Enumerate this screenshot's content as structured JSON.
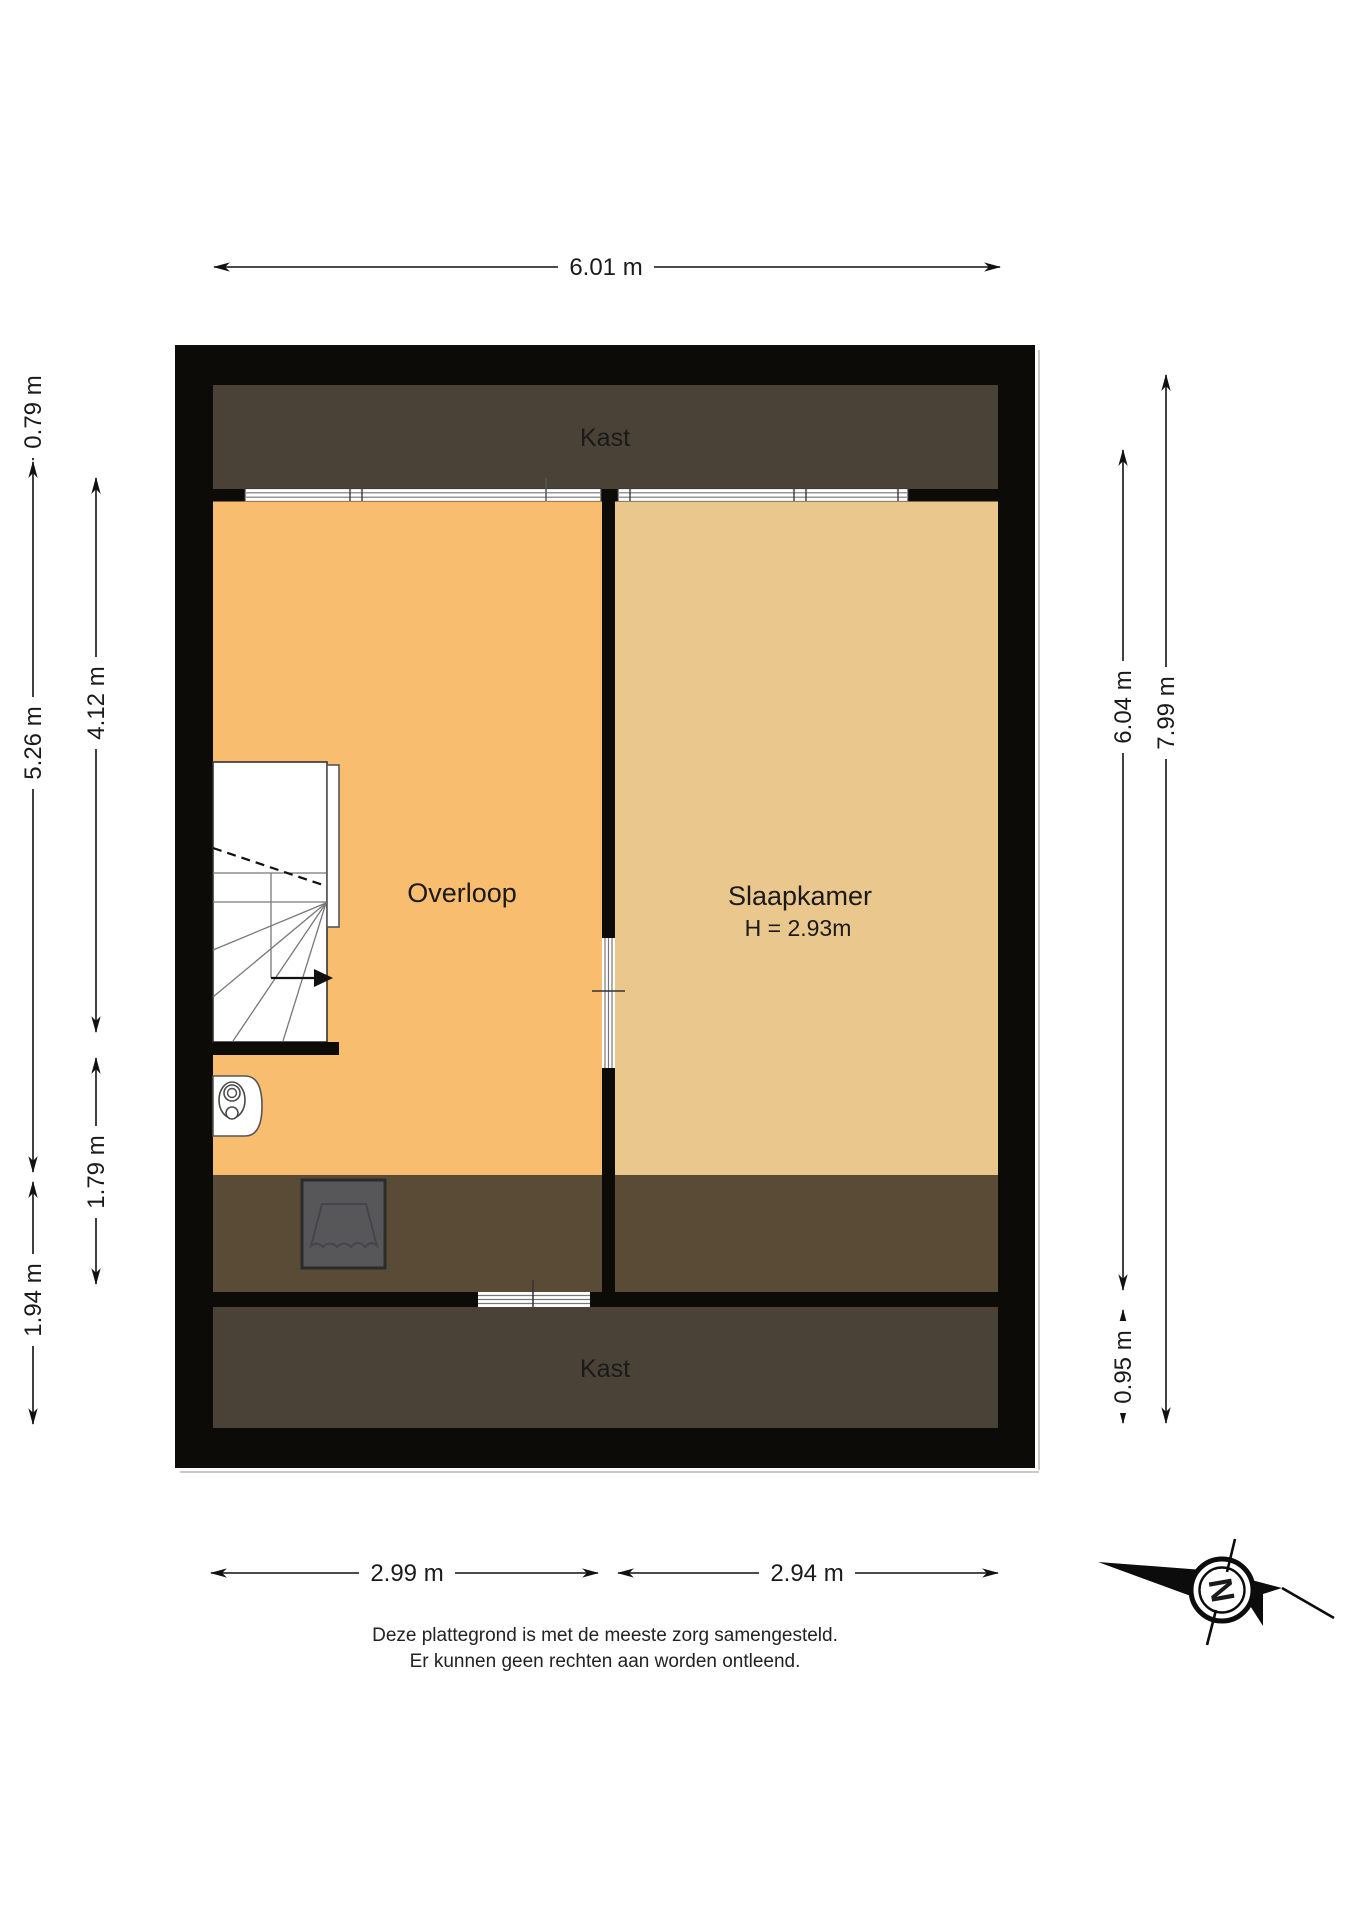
{
  "rooms": {
    "top_kast": "Kast",
    "overloop": "Overloop",
    "slaapkamer": "Slaapkamer",
    "slaapkamer_height": "H = 2.93m",
    "bottom_kast": "Kast"
  },
  "dims": {
    "top": "6.01 m",
    "bottom_left": "2.99 m",
    "bottom_right": "2.94 m",
    "left_outer_top": "0.79 m",
    "left_outer_mid": "5.26 m",
    "left_outer_bottom": "1.94 m",
    "left_inner_top": "4.12 m",
    "left_inner_bottom": "1.79 m",
    "right_inner_top": "6.04 m",
    "right_inner_bottom": "0.95 m",
    "right_outer": "7.99 m"
  },
  "compass": {
    "label": "N"
  },
  "disclaimer": {
    "line1": "Deze plattegrond is met de meeste zorg samengesteld.",
    "line2": "Er kunnen geen rechten aan worden ontleend."
  },
  "colors": {
    "wall": "#0d0b08",
    "kast": "#4a4237",
    "strip": "#594b35",
    "overloop": "#f9bd70",
    "slaapkamer": "#e9c78d",
    "skylight": "#57575a"
  }
}
